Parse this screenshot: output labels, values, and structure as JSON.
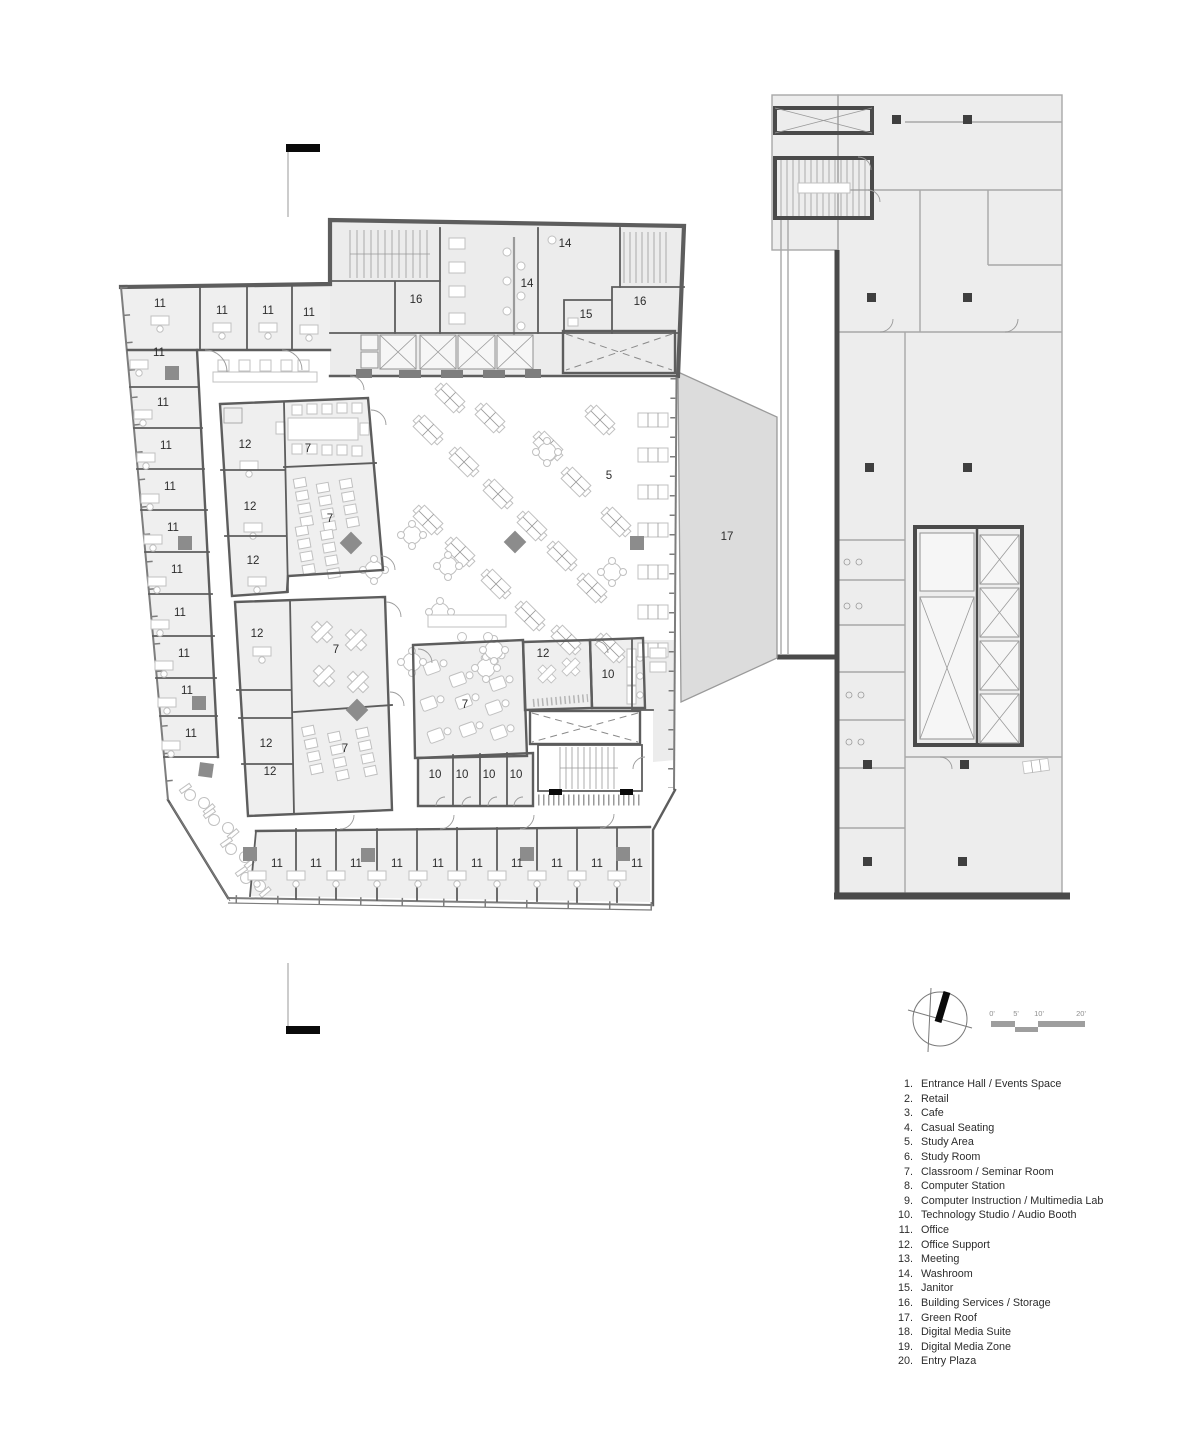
{
  "document": {
    "type": "architectural-floor-plan"
  },
  "legend": {
    "items": [
      {
        "num": "1.",
        "label": "Entrance Hall / Events Space"
      },
      {
        "num": "2.",
        "label": "Retail"
      },
      {
        "num": "3.",
        "label": "Cafe"
      },
      {
        "num": "4.",
        "label": "Casual Seating"
      },
      {
        "num": "5.",
        "label": "Study Area"
      },
      {
        "num": "6.",
        "label": "Study Room"
      },
      {
        "num": "7.",
        "label": "Classroom / Seminar Room"
      },
      {
        "num": "8.",
        "label": "Computer Station"
      },
      {
        "num": "9.",
        "label": "Computer Instruction / Multimedia Lab"
      },
      {
        "num": "10.",
        "label": "Technology Studio / Audio Booth"
      },
      {
        "num": "11.",
        "label": "Office"
      },
      {
        "num": "12.",
        "label": "Office Support"
      },
      {
        "num": "13.",
        "label": "Meeting"
      },
      {
        "num": "14.",
        "label": "Washroom"
      },
      {
        "num": "15.",
        "label": "Janitor"
      },
      {
        "num": "16.",
        "label": "Building Services / Storage"
      },
      {
        "num": "17.",
        "label": "Green Roof"
      },
      {
        "num": "18.",
        "label": "Digital Media Suite"
      },
      {
        "num": "19.",
        "label": "Digital Media Zone"
      },
      {
        "num": "20.",
        "label": "Entry Plaza"
      }
    ]
  },
  "scale_bar": {
    "tick_labels": [
      "0'",
      "5'",
      "10'",
      "20'"
    ]
  },
  "plan": {
    "colors": {
      "room_fill": "#efefef",
      "core_fill": "#ececec",
      "wall": "#5d5d5d",
      "adjacent_fill": "#ededed",
      "adjacent_wall": "#a8a8a8",
      "adjacent_wall_dark": "#4a4a4a",
      "green_roof": "#dcdcdc",
      "column": "#8c8c8c",
      "text": "#2c2c2c"
    },
    "room_labels": [
      {
        "t": "11",
        "x": 160,
        "y": 307
      },
      {
        "t": "11",
        "x": 222,
        "y": 314
      },
      {
        "t": "11",
        "x": 268,
        "y": 314
      },
      {
        "t": "11",
        "x": 309,
        "y": 316
      },
      {
        "t": "11",
        "x": 159,
        "y": 356
      },
      {
        "t": "11",
        "x": 163,
        "y": 406
      },
      {
        "t": "11",
        "x": 166,
        "y": 449
      },
      {
        "t": "11",
        "x": 170,
        "y": 490
      },
      {
        "t": "11",
        "x": 173,
        "y": 531
      },
      {
        "t": "11",
        "x": 177,
        "y": 573
      },
      {
        "t": "11",
        "x": 180,
        "y": 616
      },
      {
        "t": "11",
        "x": 184,
        "y": 657
      },
      {
        "t": "11",
        "x": 187,
        "y": 694
      },
      {
        "t": "11",
        "x": 191,
        "y": 737
      },
      {
        "t": "11",
        "x": 277,
        "y": 867
      },
      {
        "t": "11",
        "x": 316,
        "y": 867
      },
      {
        "t": "11",
        "x": 356,
        "y": 867
      },
      {
        "t": "11",
        "x": 397,
        "y": 867
      },
      {
        "t": "11",
        "x": 438,
        "y": 867
      },
      {
        "t": "11",
        "x": 477,
        "y": 867
      },
      {
        "t": "11",
        "x": 517,
        "y": 867
      },
      {
        "t": "11",
        "x": 557,
        "y": 867
      },
      {
        "t": "11",
        "x": 597,
        "y": 867
      },
      {
        "t": "11",
        "x": 637,
        "y": 867
      },
      {
        "t": "12",
        "x": 245,
        "y": 448
      },
      {
        "t": "12",
        "x": 250,
        "y": 510
      },
      {
        "t": "12",
        "x": 253,
        "y": 564
      },
      {
        "t": "12",
        "x": 257,
        "y": 637
      },
      {
        "t": "12",
        "x": 266,
        "y": 747
      },
      {
        "t": "12",
        "x": 270,
        "y": 775
      },
      {
        "t": "12",
        "x": 543,
        "y": 657
      },
      {
        "t": "7",
        "x": 308,
        "y": 452
      },
      {
        "t": "7",
        "x": 330,
        "y": 522
      },
      {
        "t": "7",
        "x": 336,
        "y": 653
      },
      {
        "t": "7",
        "x": 345,
        "y": 752
      },
      {
        "t": "7",
        "x": 465,
        "y": 708
      },
      {
        "t": "10",
        "x": 608,
        "y": 678
      },
      {
        "t": "10",
        "x": 435,
        "y": 778
      },
      {
        "t": "10",
        "x": 462,
        "y": 778
      },
      {
        "t": "10",
        "x": 489,
        "y": 778
      },
      {
        "t": "10",
        "x": 516,
        "y": 778
      },
      {
        "t": "14",
        "x": 527,
        "y": 287
      },
      {
        "t": "14",
        "x": 565,
        "y": 247
      },
      {
        "t": "15",
        "x": 586,
        "y": 318
      },
      {
        "t": "16",
        "x": 416,
        "y": 303
      },
      {
        "t": "16",
        "x": 640,
        "y": 305
      },
      {
        "t": "5",
        "x": 609,
        "y": 479
      },
      {
        "t": "17",
        "x": 727,
        "y": 540
      }
    ]
  }
}
